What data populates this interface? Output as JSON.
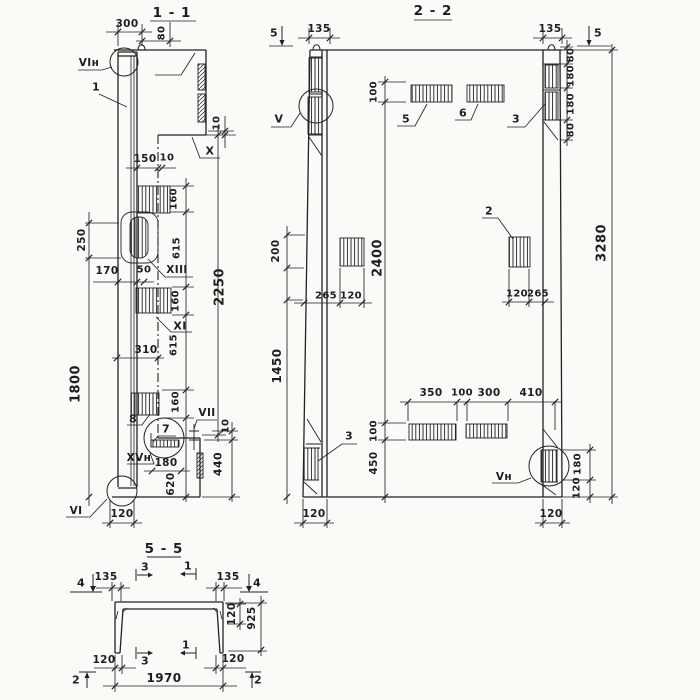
{
  "sheet": {
    "background": "#fafaf7",
    "ink": "#1e1e1e"
  },
  "views": {
    "section_1_1": {
      "title": "1 - 1",
      "labels": [
        {
          "id": "dim-300-top",
          "text": "300",
          "x": 127,
          "y": 24,
          "rot": 0,
          "fs": 10.5
        },
        {
          "id": "dim-80-top",
          "text": "80",
          "x": 162,
          "y": 33,
          "rot": 90,
          "fs": 10
        },
        {
          "id": "mark-VIn-top",
          "text": "VIн",
          "x": 89,
          "y": 63,
          "rot": 0,
          "fs": 10.5
        },
        {
          "id": "piece-1",
          "text": "1",
          "x": 96,
          "y": 87,
          "rot": 0,
          "fs": 11
        },
        {
          "id": "dim-10-upper",
          "text": "10",
          "x": 217,
          "y": 123,
          "rot": 90,
          "fs": 10
        },
        {
          "id": "mark-X",
          "text": "X",
          "x": 210,
          "y": 151,
          "rot": 0,
          "fs": 11
        },
        {
          "id": "dim-150",
          "text": "150",
          "x": 145,
          "y": 159,
          "rot": 0,
          "fs": 10.5
        },
        {
          "id": "dim-10-step",
          "text": "10",
          "x": 167,
          "y": 158,
          "rot": 0,
          "fs": 10
        },
        {
          "id": "dim-160-a",
          "text": "160",
          "x": 174,
          "y": 199,
          "rot": 90,
          "fs": 10
        },
        {
          "id": "dim-250",
          "text": "250",
          "x": 82,
          "y": 240,
          "rot": 90,
          "fs": 10.5
        },
        {
          "id": "dim-615-a",
          "text": "615",
          "x": 177,
          "y": 248,
          "rot": 90,
          "fs": 10
        },
        {
          "id": "dim-2250",
          "text": "2250",
          "x": 220,
          "y": 287,
          "rot": 90,
          "fs": 13
        },
        {
          "id": "dim-170",
          "text": "170",
          "x": 107,
          "y": 271,
          "rot": 0,
          "fs": 10.5
        },
        {
          "id": "dim-50",
          "text": "50",
          "x": 144,
          "y": 270,
          "rot": 0,
          "fs": 10
        },
        {
          "id": "mark-XIII",
          "text": "XIII",
          "x": 177,
          "y": 270,
          "rot": 0,
          "fs": 10.5
        },
        {
          "id": "dim-160-b",
          "text": "160",
          "x": 176,
          "y": 301,
          "rot": 90,
          "fs": 10
        },
        {
          "id": "mark-XI",
          "text": "XI",
          "x": 180,
          "y": 326,
          "rot": 0,
          "fs": 11
        },
        {
          "id": "dim-310",
          "text": "310",
          "x": 146,
          "y": 350,
          "rot": 0,
          "fs": 10.5
        },
        {
          "id": "dim-615-b",
          "text": "615",
          "x": 174,
          "y": 345,
          "rot": 90,
          "fs": 10
        },
        {
          "id": "dim-1800",
          "text": "1800",
          "x": 76,
          "y": 384,
          "rot": 90,
          "fs": 13
        },
        {
          "id": "piece-8",
          "text": "8",
          "x": 133,
          "y": 419,
          "rot": 0,
          "fs": 11
        },
        {
          "id": "dim-160-c",
          "text": "160",
          "x": 176,
          "y": 402,
          "rot": 90,
          "fs": 10
        },
        {
          "id": "piece-7",
          "text": "7",
          "x": 166,
          "y": 429,
          "rot": 0,
          "fs": 11
        },
        {
          "id": "mark-VII",
          "text": "VII",
          "x": 207,
          "y": 413,
          "rot": 0,
          "fs": 10.5
        },
        {
          "id": "dim-10-lower",
          "text": "10",
          "x": 226,
          "y": 426,
          "rot": 90,
          "fs": 10
        },
        {
          "id": "mark-XVn",
          "text": "XVн",
          "x": 139,
          "y": 458,
          "rot": 0,
          "fs": 10.5
        },
        {
          "id": "dim-180-bottom",
          "text": "180",
          "x": 166,
          "y": 463,
          "rot": 0,
          "fs": 10.5
        },
        {
          "id": "dim-440",
          "text": "440",
          "x": 218,
          "y": 464,
          "rot": 90,
          "fs": 11
        },
        {
          "id": "dim-620",
          "text": "620",
          "x": 171,
          "y": 484,
          "rot": 90,
          "fs": 10.5
        },
        {
          "id": "mark-VI-bottom",
          "text": "VI",
          "x": 76,
          "y": 511,
          "rot": 0,
          "fs": 10.5
        },
        {
          "id": "dim-120-bottom",
          "text": "120",
          "x": 122,
          "y": 514,
          "rot": 0,
          "fs": 10.5
        }
      ]
    },
    "section_2_2": {
      "title": "2 - 2",
      "labels": [
        {
          "id": "cut-5-left",
          "text": "5",
          "x": 274,
          "y": 33,
          "rot": 0,
          "fs": 11
        },
        {
          "id": "dim-135-left",
          "text": "135",
          "x": 319,
          "y": 29,
          "rot": 0,
          "fs": 10.5
        },
        {
          "id": "dim-135-right",
          "text": "135",
          "x": 550,
          "y": 29,
          "rot": 0,
          "fs": 10.5
        },
        {
          "id": "cut-5-right",
          "text": "5",
          "x": 598,
          "y": 33,
          "rot": 0,
          "fs": 11
        },
        {
          "id": "dim-80-r1",
          "text": "80",
          "x": 571,
          "y": 55,
          "rot": 90,
          "fs": 10
        },
        {
          "id": "dim-180-r1",
          "text": "180",
          "x": 571,
          "y": 76,
          "rot": 90,
          "fs": 10
        },
        {
          "id": "dim-180-r2",
          "text": "180",
          "x": 571,
          "y": 104,
          "rot": 90,
          "fs": 10
        },
        {
          "id": "dim-80-r2",
          "text": "80",
          "x": 571,
          "y": 130,
          "rot": 90,
          "fs": 10
        },
        {
          "id": "dim-3280",
          "text": "3280",
          "x": 602,
          "y": 243,
          "rot": 90,
          "fs": 13
        },
        {
          "id": "mark-V",
          "text": "V",
          "x": 279,
          "y": 119,
          "rot": 0,
          "fs": 11
        },
        {
          "id": "dim-100-top",
          "text": "100",
          "x": 374,
          "y": 92,
          "rot": 90,
          "fs": 10
        },
        {
          "id": "piece-5",
          "text": "5",
          "x": 406,
          "y": 119,
          "rot": 0,
          "fs": 11
        },
        {
          "id": "piece-6",
          "text": "6",
          "x": 463,
          "y": 113,
          "rot": 0,
          "fs": 11
        },
        {
          "id": "piece-3-top",
          "text": "3",
          "x": 516,
          "y": 119,
          "rot": 0,
          "fs": 11
        },
        {
          "id": "dim-200",
          "text": "200",
          "x": 276,
          "y": 251,
          "rot": 90,
          "fs": 10.5
        },
        {
          "id": "dim-2400",
          "text": "2400",
          "x": 378,
          "y": 258,
          "rot": 90,
          "fs": 13
        },
        {
          "id": "piece-2",
          "text": "2",
          "x": 489,
          "y": 211,
          "rot": 0,
          "fs": 11
        },
        {
          "id": "dim-265-l",
          "text": "265",
          "x": 326,
          "y": 296,
          "rot": 0,
          "fs": 10
        },
        {
          "id": "dim-120-l",
          "text": "120",
          "x": 351,
          "y": 296,
          "rot": 0,
          "fs": 10
        },
        {
          "id": "dim-120-r",
          "text": "120",
          "x": 517,
          "y": 294,
          "rot": 0,
          "fs": 10
        },
        {
          "id": "dim-265-r",
          "text": "265",
          "x": 538,
          "y": 294,
          "rot": 0,
          "fs": 10
        },
        {
          "id": "dim-1450",
          "text": "1450",
          "x": 277,
          "y": 366,
          "rot": 90,
          "fs": 12
        },
        {
          "id": "dim-350",
          "text": "350",
          "x": 431,
          "y": 393,
          "rot": 0,
          "fs": 10.5
        },
        {
          "id": "dim-100-mid",
          "text": "100",
          "x": 462,
          "y": 393,
          "rot": 0,
          "fs": 10
        },
        {
          "id": "dim-300-mid",
          "text": "300",
          "x": 489,
          "y": 393,
          "rot": 0,
          "fs": 10.5
        },
        {
          "id": "dim-410",
          "text": "410",
          "x": 531,
          "y": 393,
          "rot": 0,
          "fs": 10.5
        },
        {
          "id": "dim-100-bot",
          "text": "100",
          "x": 374,
          "y": 431,
          "rot": 90,
          "fs": 10
        },
        {
          "id": "dim-450",
          "text": "450",
          "x": 374,
          "y": 463,
          "rot": 90,
          "fs": 10.5
        },
        {
          "id": "piece-3-bottom",
          "text": "3",
          "x": 349,
          "y": 436,
          "rot": 0,
          "fs": 11
        },
        {
          "id": "mark-Vn",
          "text": "Vн",
          "x": 504,
          "y": 477,
          "rot": 0,
          "fs": 10.5
        },
        {
          "id": "dim-180-br",
          "text": "180",
          "x": 578,
          "y": 464,
          "rot": 90,
          "fs": 10
        },
        {
          "id": "dim-120-br",
          "text": "120",
          "x": 577,
          "y": 488,
          "rot": 90,
          "fs": 10
        },
        {
          "id": "dim-120-bl-col",
          "text": "120",
          "x": 314,
          "y": 514,
          "rot": 0,
          "fs": 10.5
        },
        {
          "id": "dim-120-br-col",
          "text": "120",
          "x": 551,
          "y": 514,
          "rot": 0,
          "fs": 10.5
        }
      ]
    },
    "section_5_5": {
      "title": "5 - 5",
      "labels": [
        {
          "id": "cut-4-left",
          "text": "4",
          "x": 81,
          "y": 583,
          "rot": 0,
          "fs": 11
        },
        {
          "id": "dim-135-tl",
          "text": "135",
          "x": 106,
          "y": 577,
          "rot": 0,
          "fs": 10.5
        },
        {
          "id": "cut-3-top",
          "text": "3",
          "x": 145,
          "y": 567,
          "rot": 0,
          "fs": 11
        },
        {
          "id": "cut-1-top",
          "text": "1",
          "x": 188,
          "y": 566,
          "rot": 0,
          "fs": 11
        },
        {
          "id": "dim-135-tr",
          "text": "135",
          "x": 228,
          "y": 577,
          "rot": 0,
          "fs": 10.5
        },
        {
          "id": "cut-4-right",
          "text": "4",
          "x": 257,
          "y": 583,
          "rot": 0,
          "fs": 11
        },
        {
          "id": "dim-120-slab",
          "text": "120",
          "x": 232,
          "y": 614,
          "rot": 90,
          "fs": 10.5
        },
        {
          "id": "dim-925",
          "text": "925",
          "x": 252,
          "y": 618,
          "rot": 90,
          "fs": 10.5
        },
        {
          "id": "dim-120-leg-l",
          "text": "120",
          "x": 104,
          "y": 660,
          "rot": 0,
          "fs": 10.5
        },
        {
          "id": "cut-3-bottom",
          "text": "3",
          "x": 145,
          "y": 661,
          "rot": 0,
          "fs": 11
        },
        {
          "id": "cut-1-bottom",
          "text": "1",
          "x": 186,
          "y": 645,
          "rot": 0,
          "fs": 11
        },
        {
          "id": "dim-120-leg-r",
          "text": "120",
          "x": 233,
          "y": 659,
          "rot": 0,
          "fs": 10.5
        },
        {
          "id": "cut-2-left",
          "text": "2",
          "x": 76,
          "y": 680,
          "rot": 0,
          "fs": 11
        },
        {
          "id": "dim-1970",
          "text": "1970",
          "x": 164,
          "y": 678,
          "rot": 0,
          "fs": 12
        },
        {
          "id": "cut-2-right",
          "text": "2",
          "x": 258,
          "y": 680,
          "rot": 0,
          "fs": 11
        }
      ]
    }
  }
}
